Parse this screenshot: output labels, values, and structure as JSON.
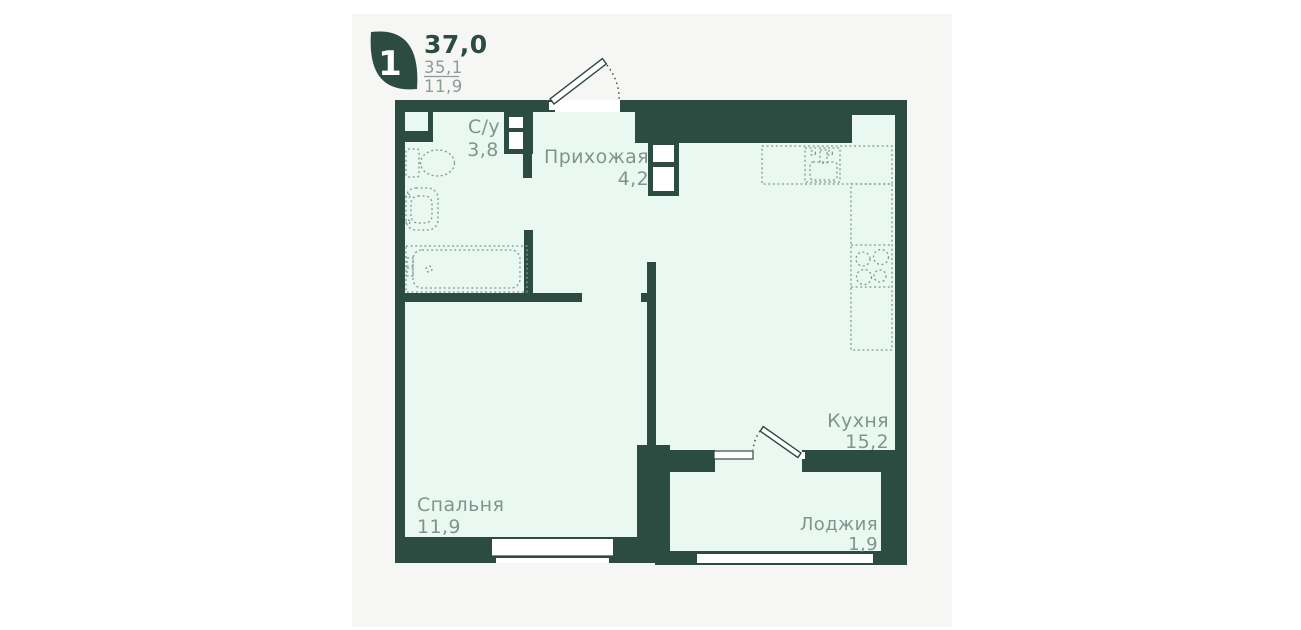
{
  "header": {
    "rooms_badge": "1",
    "area_total": "37,0",
    "area_living": "35,1",
    "area_room": "11,9"
  },
  "rooms": [
    {
      "name": "С/у",
      "area": "3,8"
    },
    {
      "name": "Прихожая",
      "area": "4,2"
    },
    {
      "name": "Кухня",
      "area": "15,2"
    },
    {
      "name": "Спальня",
      "area": "11,9"
    },
    {
      "name": "Лоджия",
      "area": "1,9"
    }
  ],
  "colors": {
    "wall": "#2C4C42",
    "floor": "#E9F9F1",
    "card": "#F6F6F5",
    "label": "#7E958D",
    "fixture": "#7C9A91",
    "subtext": "#8C9C96"
  }
}
